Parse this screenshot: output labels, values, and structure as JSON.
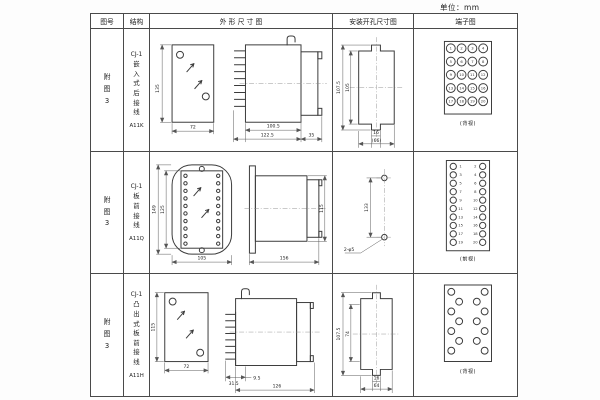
{
  "page": {
    "unit_label": "单位：mm"
  },
  "table": {
    "headers": {
      "figure_no": "图号",
      "structure": "结构",
      "outline": "外 形 尺 寸 图",
      "mounting": "安装开孔尺寸图",
      "terminal": "端子图"
    },
    "rows": [
      {
        "figure_no": "附图3",
        "series": "CJ-1",
        "structure": "嵌入式后接线",
        "model": "A11K",
        "outline": {
          "front_height": "135",
          "front_width": "72",
          "body_length": "100.5",
          "overall_length": "122.5",
          "rear_depth": "35"
        },
        "mounting": {
          "outer_height": "107.5",
          "inner_height": "105",
          "notch_width": "16",
          "overall_width": "(66)"
        },
        "terminal": {
          "view_label": "(背视)",
          "numbers": [
            "1",
            "2",
            "3",
            "4",
            "5",
            "6",
            "7",
            "8",
            "9",
            "10",
            "11",
            "12",
            "13",
            "14",
            "15",
            "16",
            "17",
            "18",
            "19",
            "20"
          ]
        }
      },
      {
        "figure_no": "附图3",
        "series": "CJ-1",
        "structure": "板前接线",
        "model": "A11Q",
        "outline": {
          "front_outer_height": "149",
          "front_inner_height": "125",
          "front_width": "105",
          "side_length": "156",
          "side_height": "115"
        },
        "mounting": {
          "hole_spacing": "133",
          "hole_callout": "2-φ5"
        },
        "terminal": {
          "view_label": "(前视)",
          "left_numbers": [
            "1",
            "3",
            "5",
            "7",
            "9",
            "11",
            "13",
            "15",
            "17",
            "19"
          ],
          "right_numbers": [
            "2",
            "4",
            "6",
            "8",
            "10",
            "12",
            "14",
            "16",
            "18",
            "20"
          ]
        }
      },
      {
        "figure_no": "附图3",
        "series": "CJ-1",
        "structure": "凸出式板前接线",
        "model": "A11H",
        "outline": {
          "front_height": "115",
          "front_width": "72",
          "front_depth": "31.5",
          "pin_length": "9.5",
          "overall_length": "126"
        },
        "mounting": {
          "outer_height": "107.5",
          "inner_height": "74",
          "notch_width": "16",
          "overall_width": "64"
        },
        "terminal": {
          "view_label": "(背视)"
        }
      }
    ]
  }
}
